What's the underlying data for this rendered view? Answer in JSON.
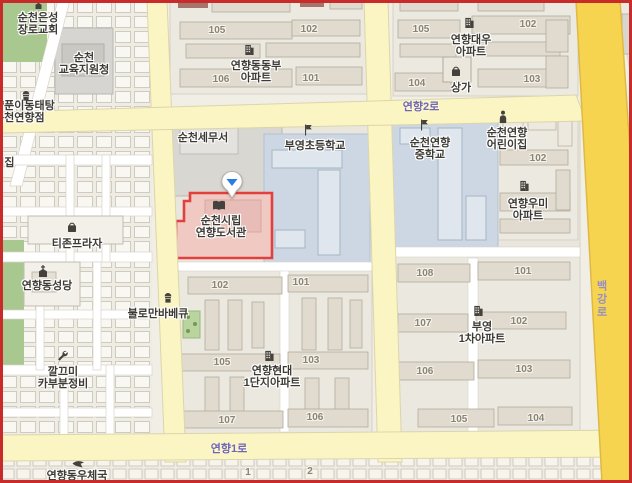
{
  "app": {
    "name": "map-view",
    "place_focused": "순천시립 연향도서관"
  },
  "pois": {
    "eunseong_church": "순천은성\n장로교회",
    "education_office": "순천\n교육지원청",
    "yangpun_restaurant": "양푼이동태탕\n순천연향점",
    "cutoff_daycare": "어린이집",
    "tizon_plaza": "티존프라자",
    "yeonhyang_cathedral": "연향동성당",
    "bulloman_bbq": "불로만바베큐",
    "kkalkkeumi_repair": "깔끄미\n카부분정비",
    "yeonhyang_post_office": "연향동우체국",
    "suncheon_tax_office": "순천세무서",
    "library": "순천시립\n연향도서관",
    "buyeong_elementary": "부영초등학교",
    "dongbu_apt": "연향동동부\n아파트",
    "daewoo_apt": "연향대우\n아파트",
    "sangga": "상가",
    "yeonhyang_middle_school": "순천연향\n중학교",
    "yeonhyang_daycare": "순천연향\n어린이집",
    "umi_apt": "연향우미\n아파트",
    "hyundai_apt": "연향현대\n1단지아파트",
    "buyeong1_apt": "부영\n1차아파트"
  },
  "roads": {
    "yeonhyang2ro": "연향2로",
    "yeonhyang1ro": "연향1로",
    "baekgangro": "백강로"
  },
  "numbers": {
    "dongbu": [
      "105",
      "102",
      "106",
      "101"
    ],
    "daewoo": [
      "105",
      "102",
      "104",
      "103"
    ],
    "umi": [
      "102"
    ],
    "hyundai": [
      "102",
      "101",
      "105",
      "103",
      "107",
      "106"
    ],
    "buyeong1": [
      "108",
      "101",
      "107",
      "102",
      "106",
      "103",
      "105",
      "104"
    ],
    "bottom_row": [
      "1",
      "2"
    ]
  },
  "marker": {
    "type": "map-pin",
    "pointing_at": "순천시립 연향도서관",
    "accent_color": "#2b7ce5"
  },
  "icons": {
    "church-cross-icon": "⛪",
    "school-flag-icon": "⚑",
    "apartment-building-icon": "🏢",
    "shopping-bag-icon": "🛍",
    "restaurant-icon": "🍴",
    "wrench-icon": "🔧",
    "person-icon": "👤",
    "book-icon": "📖",
    "post-bird-icon": "🕊"
  },
  "colors": {
    "highlight_border": "#e2403d",
    "highlight_fill": "#f1c9c3",
    "major_road": "#f6d44f",
    "minor_road": "#fbf5c3",
    "school_area": "#ccd7e3",
    "green_area": "#a9c890",
    "road_label": "#6f66b5",
    "frame": "#c92a2a"
  }
}
